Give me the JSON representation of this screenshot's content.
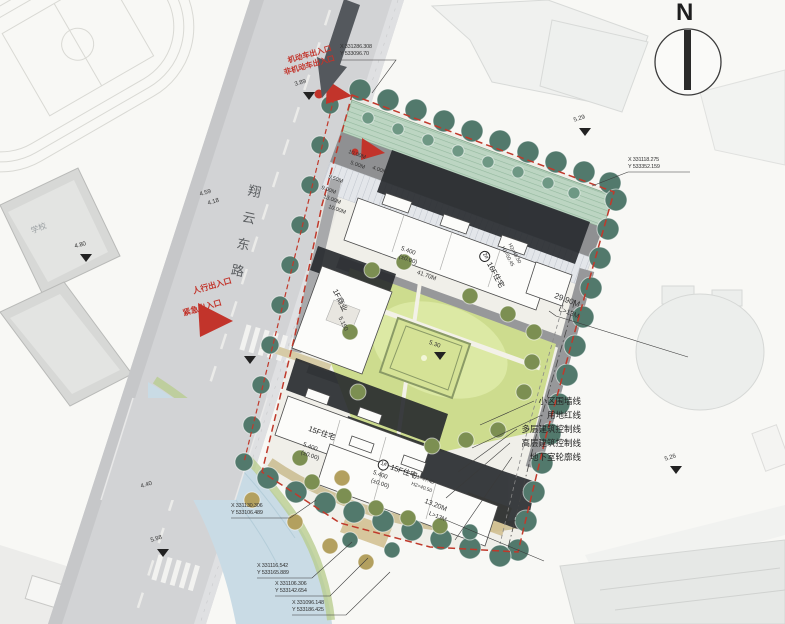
{
  "compass": {
    "north_label": "N"
  },
  "roads": {
    "main_road": "翔云东路"
  },
  "entrances": {
    "motor": "机动车出入口",
    "non_motor": "非机动车出入口",
    "pedestrian": "人行出入口",
    "emergency": "紧急出入口"
  },
  "legend": {
    "items": [
      "小区围墙线",
      "用地红线",
      "多层建筑控制线",
      "高层建筑控制线",
      "地下室轮廓线"
    ]
  },
  "buildings": {
    "b1_no": "1#",
    "b1_use": "15F住宅",
    "b1_h1": "H1=47.40",
    "b1_h2": "H2=40.50",
    "b2_no": "2#",
    "b2_use": "16F住宅",
    "b2_h1": "H1=50.45",
    "b2_h2": "H2=46.50",
    "b3_use": "15F住宅",
    "commercial": "1F商业",
    "school": "学校"
  },
  "elevations": {
    "road_1": "3.89",
    "road_2": "4.59",
    "road_3": "4.18",
    "road_4": "4.40",
    "road_5": "5.98",
    "school_side": "4.80",
    "site_ne": "5.29",
    "site_se": "5.26",
    "courtyard": "5.30",
    "commercial_fl": "5.150",
    "ffl": "5.400",
    "datum": "(±0.00)"
  },
  "dimensions": {
    "d_2990": "29.90M",
    "d_l13": "L>13M",
    "d_1320": "13.20M",
    "d_l13b": "L>13M",
    "d_4170": "41.70M",
    "s_1000a": "10.00M",
    "s_500": "5.00M",
    "s_400": "4.00M",
    "s_950": "9.50M",
    "s_900": "9.00M",
    "s_1300": "13.00M",
    "s_1000b": "10.00M"
  },
  "coordinates": {
    "c1x": "X 331286.308",
    "c1y": "Y 533096.70",
    "c2x": "X 331118.275",
    "c2y": "Y 533352.159",
    "c3x": "X 331130.306",
    "c3y": "Y 533106.489",
    "c4x": "X 331116.542",
    "c4y": "Y 533165.889",
    "c5x": "X 331106.306",
    "c5y": "Y 533142.654",
    "c6x": "X 331096.148",
    "c6y": "Y 533186.425"
  }
}
